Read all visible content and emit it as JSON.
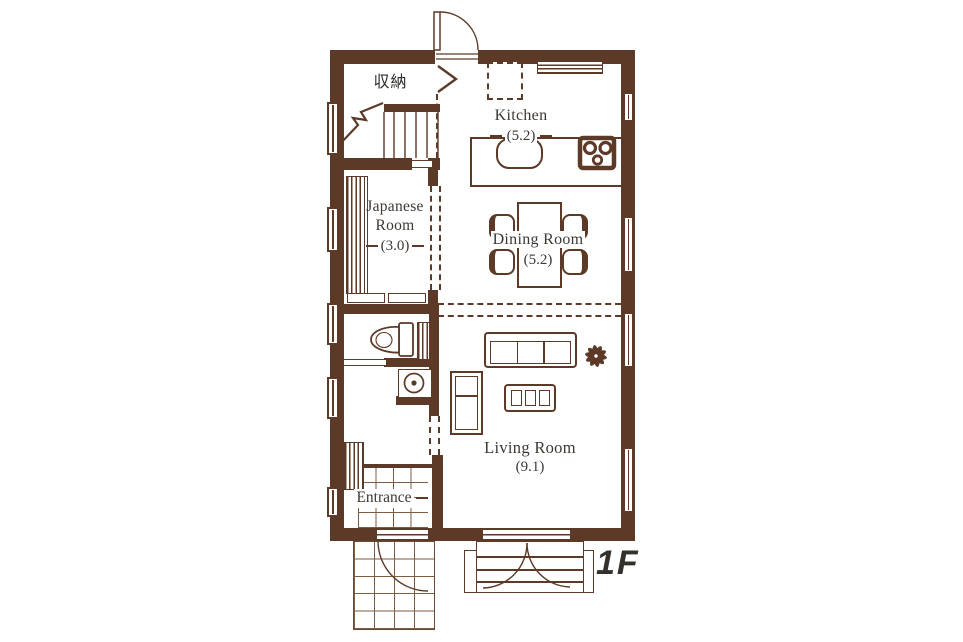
{
  "colors": {
    "wall": "#5d3a27",
    "text": "#3e3832",
    "floor_label": "#34302c"
  },
  "rooms": {
    "storage": {
      "label": "収納"
    },
    "kitchen": {
      "label": "Kitchen",
      "area": "(5.2)"
    },
    "dining": {
      "label": "Dining Room",
      "area": "(5.2)"
    },
    "japanese": {
      "label": "Japanese Room",
      "area": "(3.0)"
    },
    "living": {
      "label": "Living Room",
      "area": "(9.1)"
    },
    "entrance": {
      "label": "Entrance"
    }
  },
  "floor": {
    "label": "1F"
  }
}
